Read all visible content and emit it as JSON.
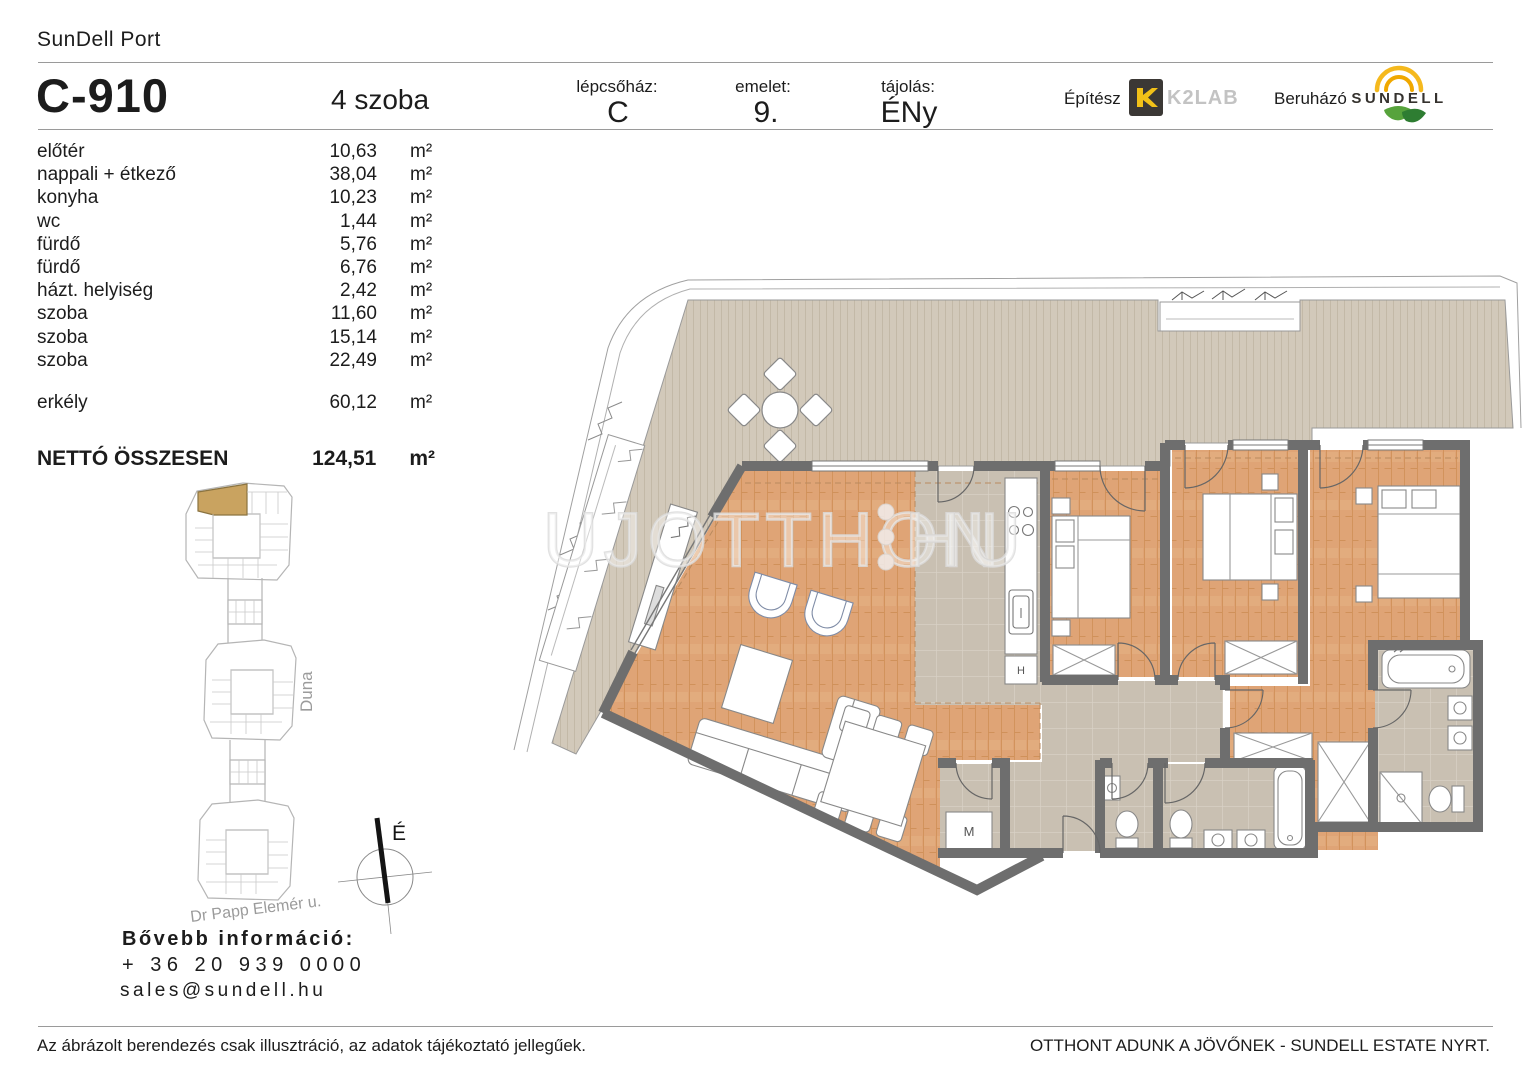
{
  "header": {
    "project": "SunDell Port",
    "unit_id": "C-910",
    "unit_type": "4 szoba",
    "staircase_label": "lépcsőház:",
    "staircase_value": "C",
    "floor_label": "emelet:",
    "floor_value": "9.",
    "orientation_label": "tájolás:",
    "orientation_value": "ÉNy",
    "architect_label": "Építész",
    "architect_name": "K2LAB",
    "developer_label": "Beruházó",
    "developer_name": "SUNDELL"
  },
  "area_unit": "m²",
  "rooms": [
    {
      "name": "előtér",
      "area": "10,63"
    },
    {
      "name": "nappali + étkező",
      "area": "38,04"
    },
    {
      "name": "konyha",
      "area": "10,23"
    },
    {
      "name": "wc",
      "area": "1,44"
    },
    {
      "name": "fürdő",
      "area": "5,76"
    },
    {
      "name": "fürdő",
      "area": "6,76"
    },
    {
      "name": "házt. helyiség",
      "area": "2,42"
    },
    {
      "name": "szoba",
      "area": "11,60"
    },
    {
      "name": "szoba",
      "area": "15,14"
    },
    {
      "name": "szoba",
      "area": "22,49"
    }
  ],
  "totals": {
    "balcony_label": "erkély",
    "balcony_area": "60,12",
    "net_label": "NETTÓ ÖSSZESEN",
    "net_area": "124,51"
  },
  "site_plan": {
    "river_label": "Duna",
    "street_label": "Dr Papp Elemér u.",
    "compass_label": "É"
  },
  "floor_plan": {
    "washing_machine_label": "M",
    "appliance_label": "H"
  },
  "watermark": {
    "text": "UJOTTHON",
    "suffix": "HU"
  },
  "contact": {
    "heading": "Bővebb információ:",
    "phone": "+ 36 20 939 0000",
    "email": "sales@sundell.hu"
  },
  "footer": {
    "disclaimer": "Az ábrázolt berendezés csak illusztráció, az adatok tájékoztató jellegűek.",
    "slogan": "OTTHONT ADUNK A JÖVŐNEK - SUNDELL ESTATE NYRT."
  },
  "colors": {
    "highlight_gold": "#c9a360",
    "wood_floor": "#dfa476",
    "terrace_deck": "#d2c9ba",
    "tile_floor": "#c9c0b2",
    "wall_gray": "#6e6e6e",
    "k2lab_yellow": "#f2c118",
    "sundell_yellow": "#f0b31c",
    "leaf_green": "#4a9b3f"
  }
}
